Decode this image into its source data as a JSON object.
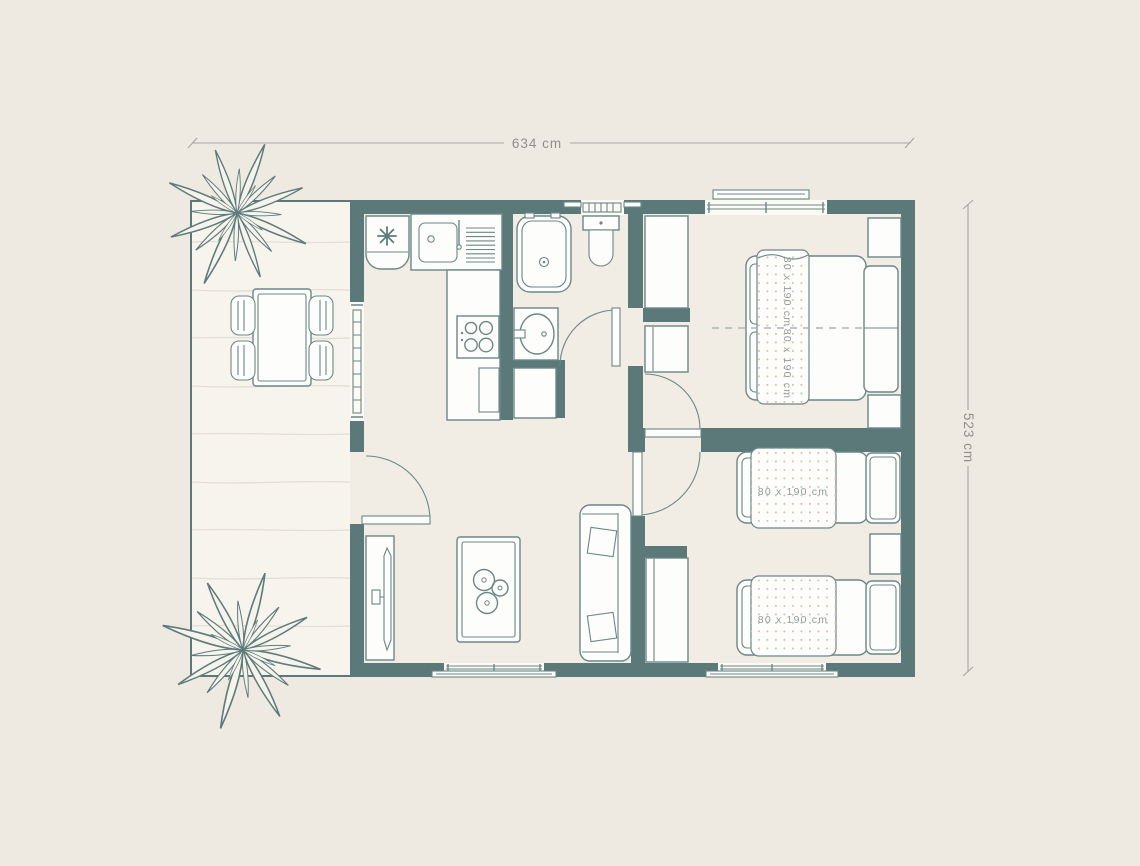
{
  "page": {
    "background": "#efeae1"
  },
  "dimensions": {
    "width_label": "634 cm",
    "height_label": "523 cm"
  },
  "bedroom_double": {
    "mattress_top_label": "80 x 190 cm",
    "mattress_bottom_label": "80 x 190 cm"
  },
  "bedroom_twin": {
    "top_bed_label": "80 x 190 cm",
    "bottom_bed_label": "80 x 190 cm"
  },
  "icons": {
    "fridge": "snowflake-icon",
    "terrace": "plant-icon",
    "stove": "burner-icon"
  },
  "colors": {
    "wall": "#5b7979",
    "floor": "#f2ede4",
    "terrace_floor": "#f7f4ed",
    "furniture_outline": "#6b8787",
    "furniture_fill": "#fdfdfb",
    "dimension_text": "#8f8f89",
    "bed_label_text": "#8d9d9b",
    "blanket_dot": "#dcc0a9",
    "plank_line": "#e3ded4",
    "dashed_split_line": "#a9b7b5"
  }
}
